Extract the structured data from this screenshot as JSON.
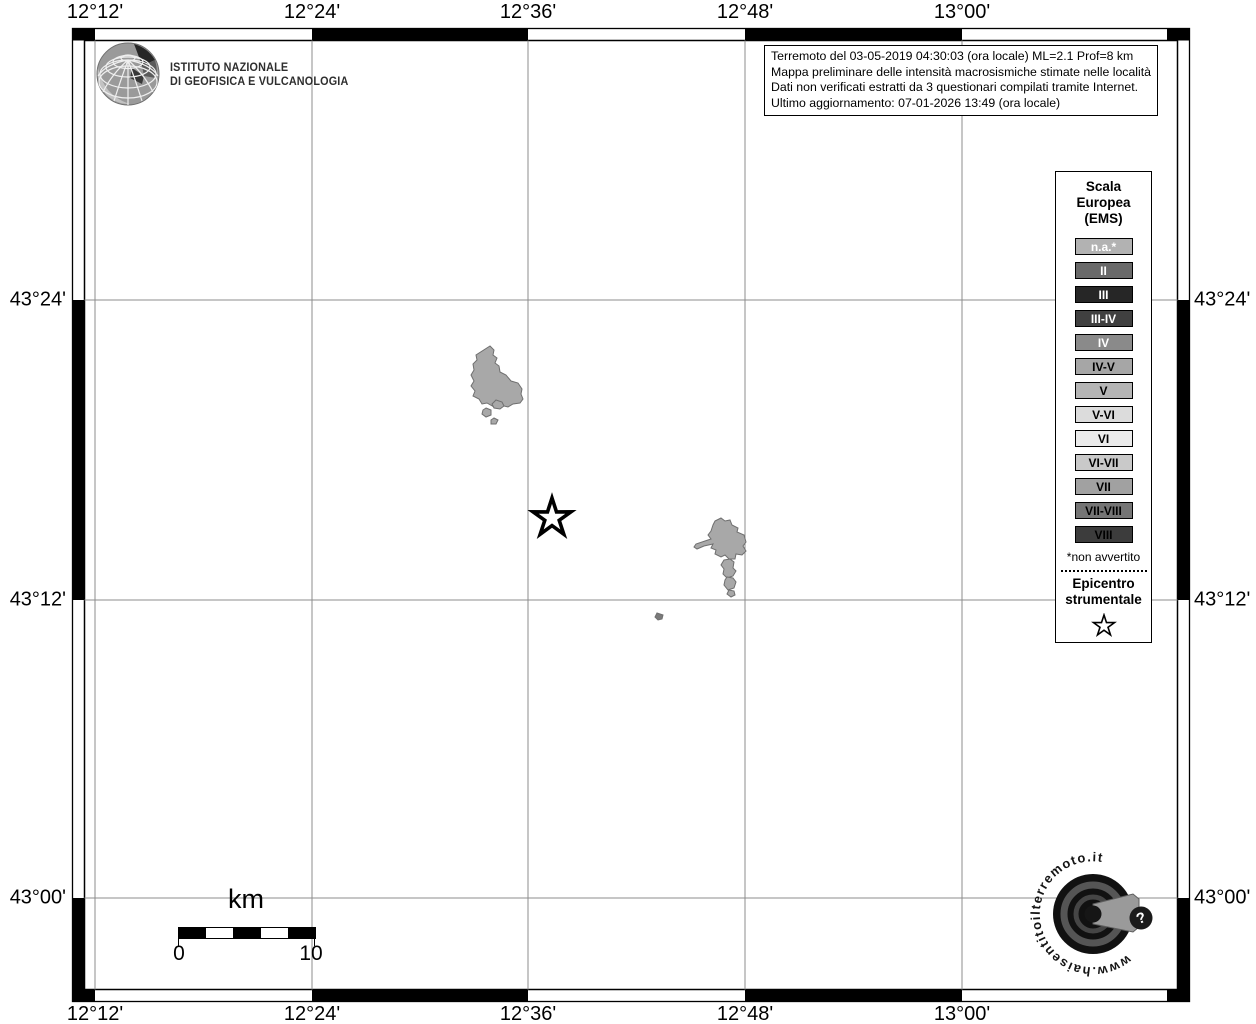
{
  "axes": {
    "top": [
      "12°12'",
      "12°24'",
      "12°36'",
      "12°48'",
      "13°00'"
    ],
    "bottom": [
      "12°12'",
      "12°24'",
      "12°36'",
      "12°48'",
      "13°00'"
    ],
    "left": [
      "43°24'",
      "43°12'",
      "43°00'"
    ],
    "right": [
      "43°24'",
      "43°12'",
      "43°00'"
    ]
  },
  "branding": {
    "institute_line1": "ISTITUTO NAZIONALE",
    "institute_line2": "DI GEOFISICA E VULCANOLOGIA"
  },
  "info_box": {
    "line1": "Terremoto del 03-05-2019 04:30:03 (ora locale) ML=2.1 Prof=8 km",
    "line2": "Mappa preliminare delle intensità macrosismiche stimate nelle località",
    "line3": "Dati non verificati estratti da 3 questionari compilati tramite Internet.",
    "line4": "Ultimo aggiornamento: 07-01-2026 13:49 (ora locale)"
  },
  "legend": {
    "title_lines": [
      "Scala",
      "Europea",
      "(EMS)"
    ],
    "items": [
      {
        "label": "n.a.*",
        "bg": "#b2b2b2",
        "fg": "#ffffff"
      },
      {
        "label": "II",
        "bg": "#696969",
        "fg": "#ffffff"
      },
      {
        "label": "III",
        "bg": "#262626",
        "fg": "#ffffff"
      },
      {
        "label": "III-IV",
        "bg": "#404040",
        "fg": "#ffffff"
      },
      {
        "label": "IV",
        "bg": "#8a8a8a",
        "fg": "#ffffff"
      },
      {
        "label": "IV-V",
        "bg": "#a6a6a6",
        "fg": "#000000"
      },
      {
        "label": "V",
        "bg": "#b5b5b5",
        "fg": "#000000"
      },
      {
        "label": "V-VI",
        "bg": "#dcdcdc",
        "fg": "#000000"
      },
      {
        "label": "VI",
        "bg": "#ebebeb",
        "fg": "#000000"
      },
      {
        "label": "VI-VII",
        "bg": "#c9c9c9",
        "fg": "#000000"
      },
      {
        "label": "VII",
        "bg": "#a1a1a1",
        "fg": "#000000"
      },
      {
        "label": "VII-VIII",
        "bg": "#757575",
        "fg": "#000000"
      },
      {
        "label": "VIII",
        "bg": "#3c3c3c",
        "fg": "#000000"
      }
    ],
    "footnote": "*non avvertito",
    "epicenter_line1": "Epicentro",
    "epicenter_line2": "strumentale"
  },
  "scalebar": {
    "unit": "km",
    "start": "0",
    "end": "10"
  },
  "watermark": {
    "url_text": "www.haisentitoilterremoto.it",
    "question_mark": "?"
  },
  "colors": {
    "gridline": "#8c8c8c",
    "lake_fill": "#a8a8a8",
    "lake_stroke": "#6f6f6f",
    "frame": "#000000"
  }
}
